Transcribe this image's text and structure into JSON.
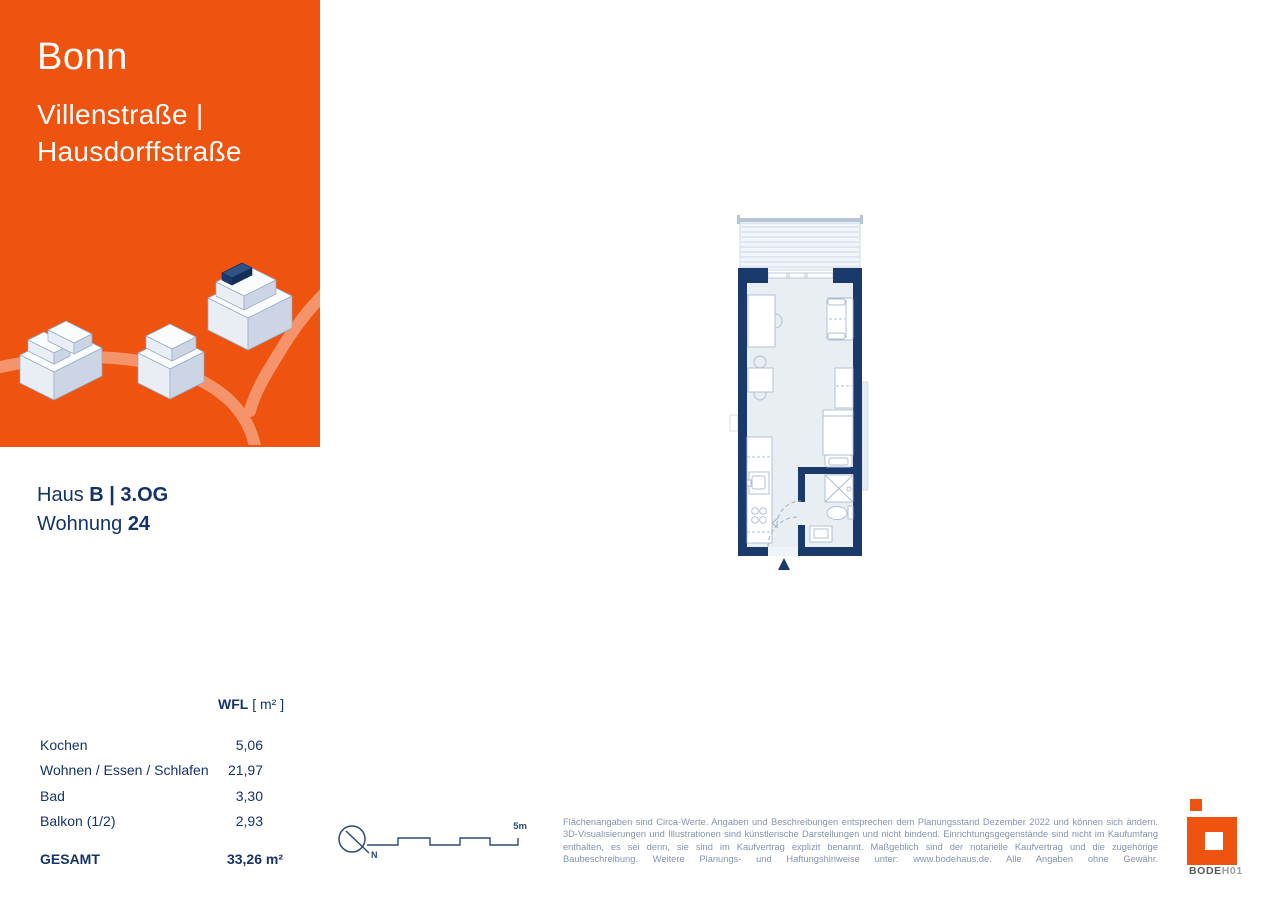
{
  "header": {
    "city": "Bonn",
    "street_line1": "Villenstraße |",
    "street_line2": "Hausdorffstraße"
  },
  "unit": {
    "haus_label": "Haus ",
    "haus_value": "B | 3.OG",
    "wohnung_label": "Wohnung ",
    "wohnung_value": "24"
  },
  "area_table": {
    "header_bold": "WFL",
    "header_unit": " [ m² ]",
    "rows": [
      {
        "label": "Kochen",
        "value": "5,06"
      },
      {
        "label": "Wohnen / Essen / Schlafen",
        "value": "21,97"
      },
      {
        "label": "Bad",
        "value": "3,30"
      },
      {
        "label": "Balkon (1/2)",
        "value": "2,93"
      }
    ],
    "total_label": "GESAMT",
    "total_value": "33,26 m²"
  },
  "scale_bar": {
    "label": "5m"
  },
  "compass": {
    "label": "N"
  },
  "disclaimer": "Flächenangaben sind Circa-Werte. Angaben und Beschreibungen entsprechen dem Planungsstand Dezember 2022 und können sich ändern. 3D-Visualisierungen und Illustrationen sind künstlerische Darstellungen und nicht bindend. Einrichtungsgegenstände sind nicht im Kaufumfang enthalten, es sei denn, sie sind im Kaufvertrag explizit benannt. Maßgeblich sind der notarielle Kaufvertrag und die zugehörige Baubeschreibung. Weitere Planungs- und Haftungshinweise unter: www.bodehaus.de. Alle Angaben ohne Gewähr.",
  "logo": {
    "brand_bold": "BODE",
    "brand_light": "H01"
  },
  "colors": {
    "orange": "#EE530F",
    "navy_text": "#14336B",
    "wall_navy": "#1A3A6B",
    "road": "#F5946B"
  }
}
